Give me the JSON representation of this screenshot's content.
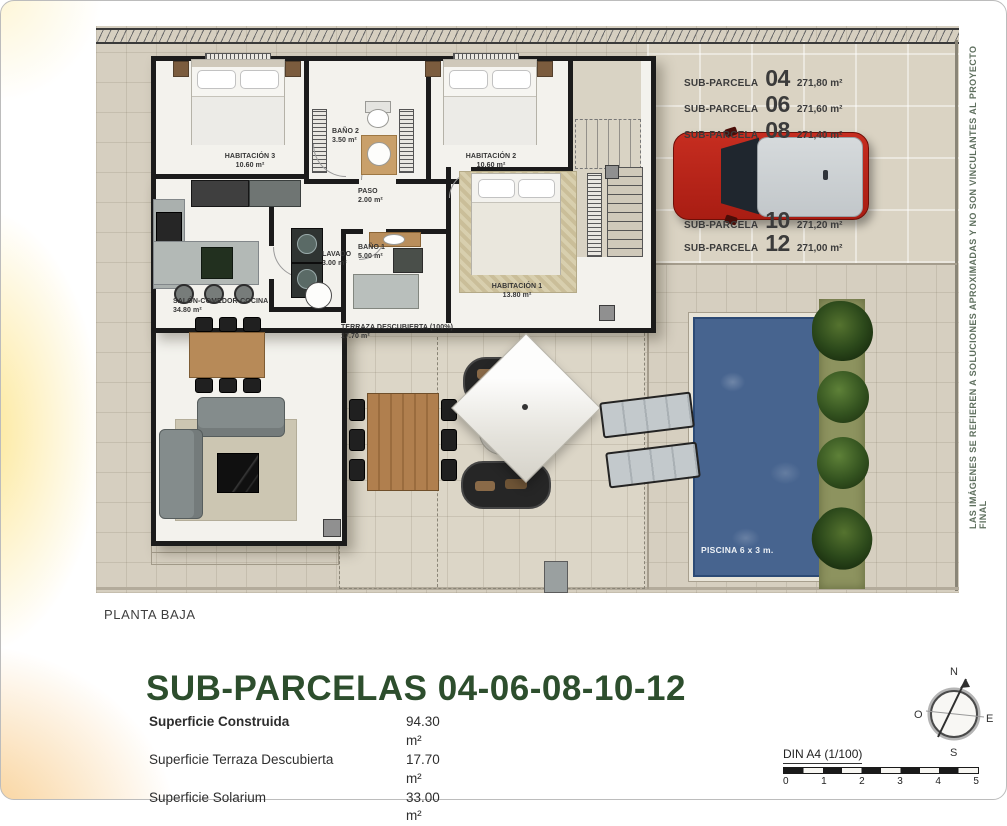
{
  "plan": {
    "rooms": [
      {
        "id": "habitacion3",
        "label": "HABITACIÓN 3",
        "area": "10.60 m²"
      },
      {
        "id": "bano2",
        "label": "BAÑO 2",
        "area": "3.50 m²"
      },
      {
        "id": "habitacion2",
        "label": "HABITACIÓN 2",
        "area": "10.60 m²"
      },
      {
        "id": "paso",
        "label": "PASO",
        "area": "2.00 m²"
      },
      {
        "id": "lavado",
        "label": "LAVADO",
        "area": "3.00 m²"
      },
      {
        "id": "bano1",
        "label": "BAÑO 1",
        "area": "5.00 m²"
      },
      {
        "id": "habitacion1",
        "label": "HABITACIÓN 1",
        "area": "13.80 m²"
      },
      {
        "id": "salon",
        "label": "SALÓN-COMEDOR-COCINA",
        "area": "34.80 m²"
      },
      {
        "id": "terraza",
        "label": "TERRAZA DESCUBIERTA (100%)",
        "area": "17.70 m²"
      }
    ],
    "pool_label": "PISCINA 6 x 3 m.",
    "subparcelas": [
      {
        "name": "SUB-PARCELA",
        "number": "04",
        "area": "271,80 m²"
      },
      {
        "name": "SUB-PARCELA",
        "number": "06",
        "area": "271,60 m²"
      },
      {
        "name": "SUB-PARCELA",
        "number": "08",
        "area": "271,40 m²"
      },
      {
        "name": "SUB-PARCELA",
        "number": "10",
        "area": "271,20 m²"
      },
      {
        "name": "SUB-PARCELA",
        "number": "12",
        "area": "271,00 m²"
      }
    ]
  },
  "footer": {
    "floor_label": "PLANTA BAJA",
    "title": "SUB-PARCELAS 04-06-08-10-12",
    "areas": [
      {
        "label": "Superficie Construida",
        "value": "94.30 m²"
      },
      {
        "label": "Superficie Terraza Descubierta",
        "value": "17.70 m²"
      },
      {
        "label": "Superficie Solarium",
        "value": "33.00 m²"
      }
    ],
    "scale": {
      "label": "DIN A4 (1/100)",
      "ticks": [
        "0",
        "1",
        "2",
        "3",
        "4",
        "5"
      ]
    },
    "compass": {
      "north": "N",
      "south": "S",
      "east": "E",
      "west": "O"
    }
  },
  "disclaimer": "LAS IMÁGENES SE REFIEREN A SOLUCIONES APROXIMADAS Y NO SON VINCULANTES AL PROYECTO FINAL",
  "colors": {
    "accent_green": "#2d4e2d",
    "car_red": "#b9261c",
    "pool_blue": "#47648f",
    "plan_beige": "#d6cfc0"
  }
}
